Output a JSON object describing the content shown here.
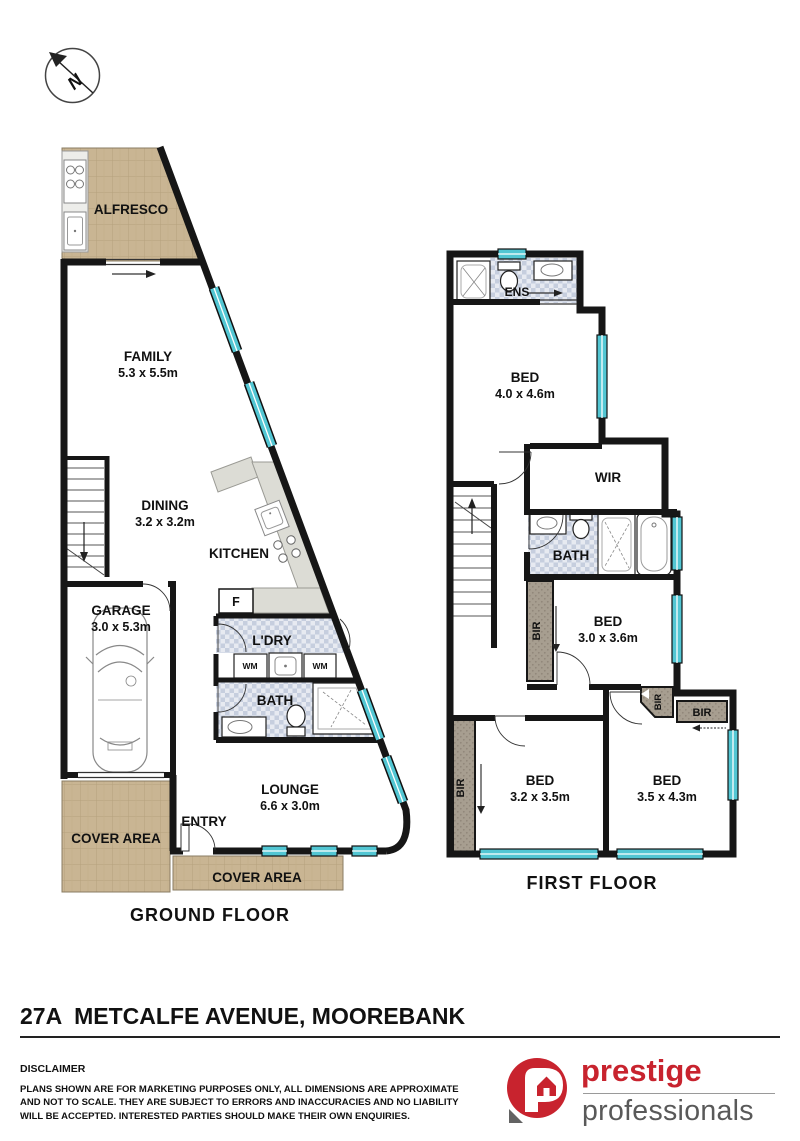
{
  "compass": {
    "label": "N"
  },
  "ground_floor": {
    "title": "GROUND FLOOR",
    "alfresco": "ALFRESCO",
    "family": {
      "name": "FAMILY",
      "dims": "5.3 x 5.5m"
    },
    "dining": {
      "name": "DINING",
      "dims": "3.2 x 3.2m"
    },
    "kitchen": "KITCHEN",
    "fridge": "F",
    "garage": {
      "name": "GARAGE",
      "dims": "3.0 x 5.3m"
    },
    "laundry": "L'DRY",
    "wm1": "WM",
    "wm2": "WM",
    "bath": "BATH",
    "lounge": {
      "name": "LOUNGE",
      "dims": "6.6 x 3.0m"
    },
    "entry": "ENTRY",
    "cover_left": "COVER AREA",
    "cover_bottom": "COVER AREA"
  },
  "first_floor": {
    "title": "FIRST FLOOR",
    "ens": "ENS",
    "bed1": {
      "name": "BED",
      "dims": "4.0 x 4.6m"
    },
    "wir": "WIR",
    "bath": "BATH",
    "bed2": {
      "name": "BED",
      "dims": "3.0 x 3.6m"
    },
    "bed3": {
      "name": "BED",
      "dims": "3.2 x 3.5m"
    },
    "bed4": {
      "name": "BED",
      "dims": "3.5 x 4.3m"
    },
    "bir_bed2": "BIR",
    "bir_corner": "BIR",
    "bir_bed4": "BIR",
    "bir_bed3": "BIR"
  },
  "footer": {
    "address": "27A  METCALFE AVENUE, MOOREBANK",
    "disclaimer_title": "DISCLAIMER",
    "disclaimer_body": "PLANS SHOWN ARE FOR MARKETING PURPOSES ONLY, ALL DIMENSIONS ARE APPROXIMATE AND NOT TO SCALE. THEY ARE SUBJECT TO ERRORS AND INACCURACIES AND NO LIABILITY WILL BE ACCEPTED. INTERESTED PARTIES SHOULD MAKE THEIR OWN ENQUIRIES.",
    "logo_line1": "prestige",
    "logo_line2": "professionals"
  },
  "colors": {
    "wall": "#161616",
    "window_glass": "#52c6d3",
    "paving": "#c9b593",
    "tile_dark": "#c6cede",
    "tile_light": "#e7eaf1",
    "robe": "#a79e90",
    "counter": "#dcdcd5",
    "brand_red": "#c8232e",
    "brand_gray": "#595959"
  }
}
